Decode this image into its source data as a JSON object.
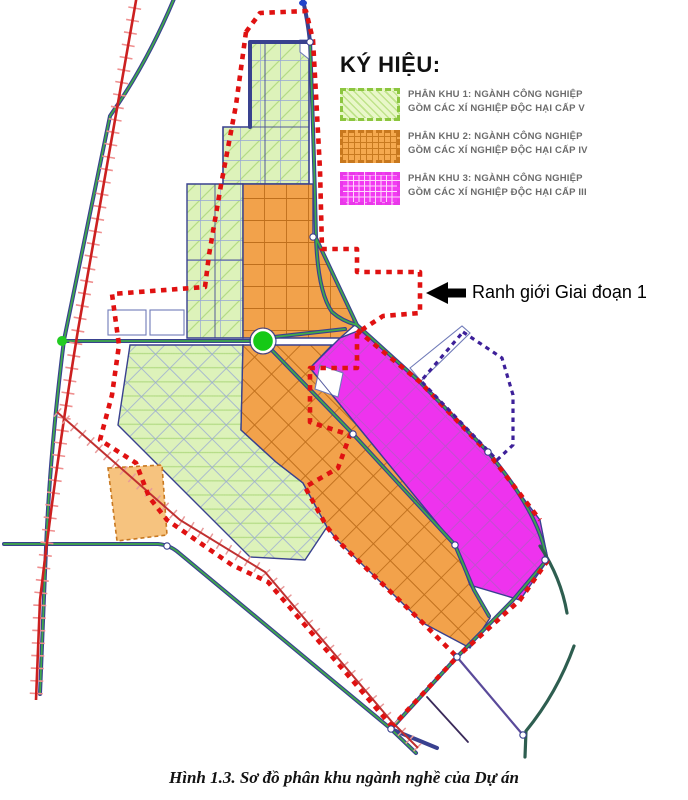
{
  "legend": {
    "title": "KÝ HIỆU:",
    "items": [
      {
        "line1": "PHÂN KHU 1: NGÀNH CÔNG NGHIỆP",
        "line2": "GỒM CÁC XÍ NGHIỆP ĐỘC HẠI CẤP V",
        "fill": "#e9f7c9",
        "border": "#8cc63f"
      },
      {
        "line1": "PHÂN KHU 2: NGÀNH CÔNG NGHIỆP",
        "line2": "GỒM CÁC XÍ NGHIỆP ĐỘC HẠI CẤP IV",
        "fill": "#f5a94f",
        "border": "#c8781e"
      },
      {
        "line1": "PHÂN KHU 3: NGÀNH CÔNG NGHIỆP",
        "line2": "GỒM CÁC XÍ NGHIỆP ĐỘC HẠI CẤP III",
        "fill": "#f23cf2",
        "border": "#e838e8"
      }
    ]
  },
  "annotation": {
    "label": "Ranh giới Giai đoạn 1"
  },
  "caption": "Hình 1.3. Sơ đồ phân khu ngành nghề của Dự án",
  "map": {
    "phase1_boundary_color": "#e01111",
    "phase2_boundary_color": "#3d2099",
    "zone1_color": "#ddf2ba",
    "zone2_color": "#f2a24b",
    "zone3_color": "#ee33ee",
    "road_color": "#39418f",
    "road_center_color": "#3faa4a",
    "railway_color": "#cc2020"
  }
}
